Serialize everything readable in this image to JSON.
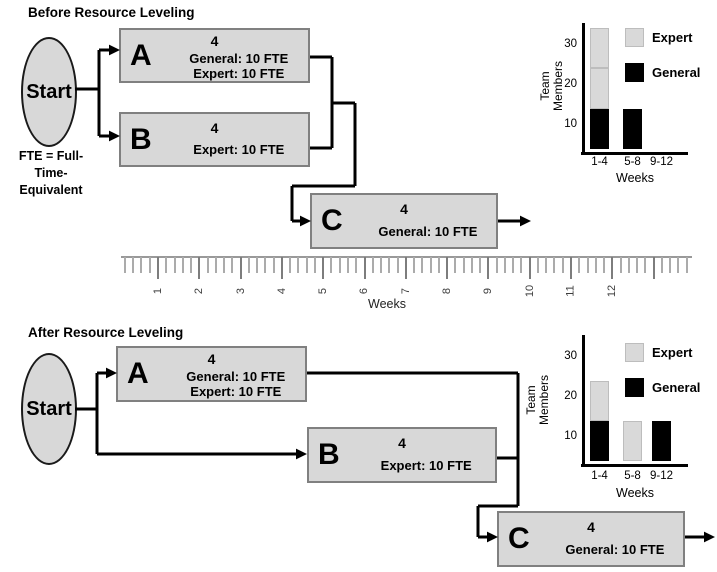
{
  "colors": {
    "task_fill": "#d8d8d8",
    "task_border": "#808080",
    "expert_gray": "#d9d9d9",
    "general_black": "#000000",
    "line_black": "#000000"
  },
  "before": {
    "title": "Before Resource Leveling",
    "start_label": "Start",
    "fte_note_lines": [
      "FTE = Full-",
      "Time-",
      "Equivalent"
    ],
    "tasks": {
      "a": {
        "letter": "A",
        "duration": "4",
        "line1": "General: 10 FTE",
        "line2": "Expert: 10 FTE"
      },
      "b": {
        "letter": "B",
        "duration": "4",
        "line1": "Expert: 10 FTE"
      },
      "c": {
        "letter": "C",
        "duration": "4",
        "line1": "General: 10 FTE"
      }
    }
  },
  "after": {
    "title": "After Resource Leveling",
    "start_label": "Start",
    "tasks": {
      "a": {
        "letter": "A",
        "duration": "4",
        "line1": "General: 10 FTE",
        "line2": "Expert: 10 FTE"
      },
      "b": {
        "letter": "B",
        "duration": "4",
        "line1": "Expert: 10 FTE"
      },
      "c": {
        "letter": "C",
        "duration": "4",
        "line1": "General: 10 FTE"
      }
    }
  },
  "timeline": {
    "axis_label": "Weeks",
    "week_labels": [
      "1",
      "2",
      "3",
      "4",
      "5",
      "6",
      "7",
      "8",
      "9",
      "10",
      "11",
      "12"
    ]
  },
  "chart_data": [
    {
      "type": "bar",
      "subtype": "stacked",
      "title": "Team members before resource leveling",
      "categories": [
        "1-4",
        "5-8",
        "9-12"
      ],
      "xlabel": "Weeks",
      "ylabel": "Team Members",
      "ylabel_lines": [
        "Team",
        "Members"
      ],
      "yticks": [
        10,
        20,
        30
      ],
      "ylim": [
        0,
        35
      ],
      "legend": [
        {
          "name": "Expert",
          "color": "#d9d9d9"
        },
        {
          "name": "General",
          "color": "#000000"
        }
      ],
      "series": [
        {
          "name": "General",
          "values": [
            10,
            10,
            0
          ]
        },
        {
          "name": "Expert",
          "values": [
            20,
            0,
            0
          ]
        }
      ],
      "stacks": [
        [
          {
            "series": "General",
            "value": 10
          },
          {
            "series": "Expert",
            "value": 10
          },
          {
            "series": "Expert",
            "value": 10
          }
        ],
        [
          {
            "series": "General",
            "value": 10
          }
        ],
        []
      ]
    },
    {
      "type": "bar",
      "subtype": "stacked",
      "title": "Team members after resource leveling",
      "categories": [
        "1-4",
        "5-8",
        "9-12"
      ],
      "xlabel": "Weeks",
      "ylabel": "Team Members",
      "ylabel_lines": [
        "Team",
        "Members"
      ],
      "yticks": [
        10,
        20,
        30
      ],
      "ylim": [
        0,
        35
      ],
      "legend": [
        {
          "name": "Expert",
          "color": "#d9d9d9"
        },
        {
          "name": "General",
          "color": "#000000"
        }
      ],
      "series": [
        {
          "name": "General",
          "values": [
            10,
            0,
            10
          ]
        },
        {
          "name": "Expert",
          "values": [
            10,
            10,
            0
          ]
        }
      ],
      "stacks": [
        [
          {
            "series": "General",
            "value": 10
          },
          {
            "series": "Expert",
            "value": 10
          }
        ],
        [
          {
            "series": "Expert",
            "value": 10
          }
        ],
        [
          {
            "series": "General",
            "value": 10
          }
        ]
      ]
    }
  ]
}
